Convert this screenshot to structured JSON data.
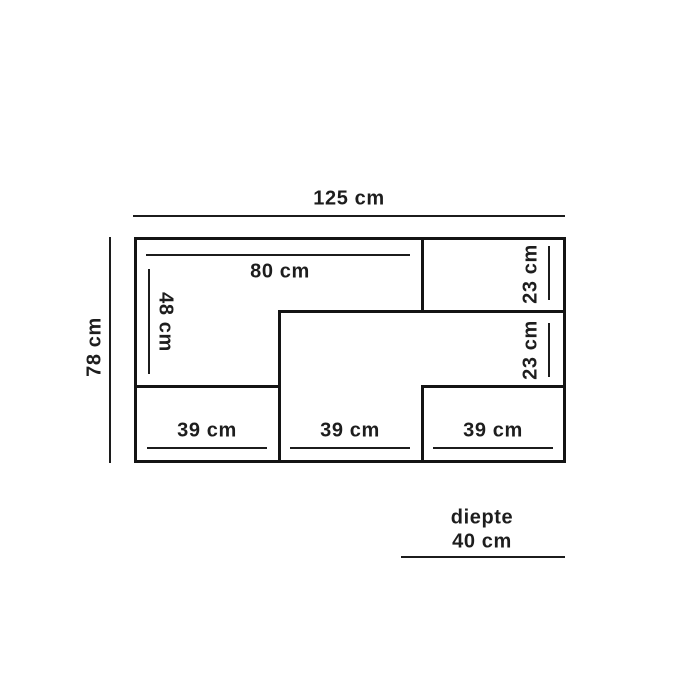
{
  "diagram": {
    "description": "cabinet-dimension-diagram",
    "unit": "cm",
    "labels": {
      "total_width": "125 cm",
      "total_height": "78 cm",
      "top_shelf_width": "80 cm",
      "left_compartment_height": "48 cm",
      "top_right_compartment_height": "23 cm",
      "middle_right_compartment_height": "23 cm",
      "bottom_left_width": "39 cm",
      "bottom_middle_width": "39 cm",
      "bottom_right_width": "39 cm",
      "depth_caption": "diepte",
      "depth_value": "40 cm"
    }
  }
}
